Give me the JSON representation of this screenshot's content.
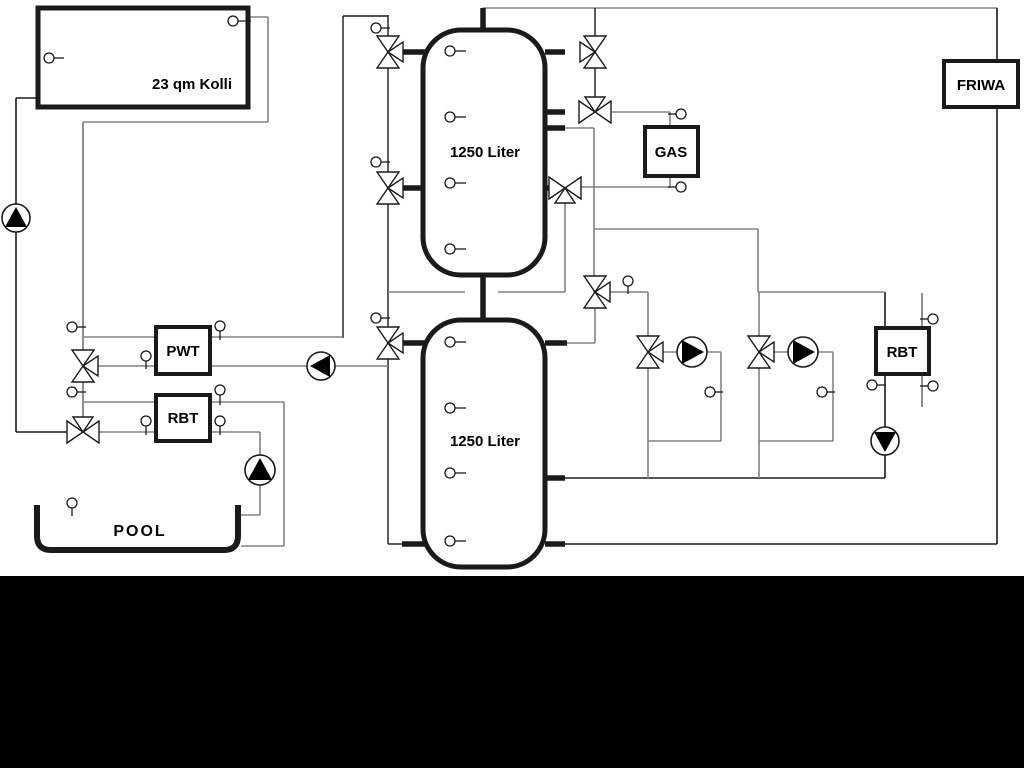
{
  "diagram": {
    "canvas": {
      "width": 1024,
      "height": 768,
      "background": "#ffffff"
    },
    "colors": {
      "black_line": "#1a1a1a",
      "gray_line": "#828282",
      "symbol_stroke": "#1a1a1a",
      "fill_white": "#ffffff",
      "band": "#000000"
    },
    "black_band": {
      "x": 0,
      "y": 576,
      "width": 1024,
      "height": 192
    },
    "boxes": [
      {
        "id": "collector-box",
        "label": "23 qm Kolli",
        "x": 38,
        "y": 8,
        "w": 210,
        "h": 99,
        "border": 5,
        "label_x": 192,
        "label_y": 89,
        "font": 15
      },
      {
        "id": "pwt-box",
        "label": "PWT",
        "x": 156,
        "y": 327,
        "w": 54,
        "h": 47,
        "border": 4,
        "label_x": 183,
        "label_y": 356,
        "font": 15
      },
      {
        "id": "rbt-pool-box",
        "label": "RBT",
        "x": 156,
        "y": 395,
        "w": 54,
        "h": 46,
        "border": 4,
        "label_x": 183,
        "label_y": 423,
        "font": 15
      },
      {
        "id": "gas-box",
        "label": "GAS",
        "x": 645,
        "y": 127,
        "w": 53,
        "h": 49,
        "border": 4,
        "label_x": 671,
        "label_y": 157,
        "font": 15
      },
      {
        "id": "rbt-heating-box",
        "label": "RBT",
        "x": 876,
        "y": 328,
        "w": 53,
        "h": 46,
        "border": 4,
        "label_x": 902,
        "label_y": 357,
        "font": 15
      },
      {
        "id": "friwa-box",
        "label": "FRIWA",
        "x": 944,
        "y": 61,
        "w": 74,
        "h": 46,
        "border": 4,
        "label_x": 981,
        "label_y": 90,
        "font": 15
      }
    ],
    "tanks": [
      {
        "id": "buffer-tank-1",
        "label": "1250 Liter",
        "x": 423,
        "y": 30,
        "w": 122,
        "h": 245,
        "rx": 38,
        "border": 5,
        "label_x": 485,
        "label_y": 157,
        "font": 15
      },
      {
        "id": "buffer-tank-2",
        "label": "1250 Liter",
        "x": 423,
        "y": 320,
        "w": 122,
        "h": 247,
        "rx": 38,
        "border": 5,
        "label_x": 485,
        "label_y": 446,
        "font": 15
      }
    ],
    "pool": {
      "id": "pool-basin",
      "label": "POOL",
      "path": "M 37,505 L 37,536 Q 37,550 51,550 L 224,550 Q 238,550 238,536 L 238,505",
      "border": 6,
      "label_x": 140,
      "label_y": 536,
      "font": 16
    },
    "lines": [
      [
        16,
        98,
        38,
        98,
        "b",
        1.6
      ],
      [
        16,
        98,
        16,
        432,
        "b",
        1.6
      ],
      [
        16,
        432,
        83,
        432,
        "b",
        1.6
      ],
      [
        483,
        8,
        997,
        8,
        "g",
        1.6
      ],
      [
        997,
        8,
        997,
        544,
        "b",
        1.6
      ],
      [
        565,
        544,
        997,
        544,
        "b",
        1.6
      ],
      [
        565,
        478,
        885,
        478,
        "b",
        1.6
      ],
      [
        885,
        292,
        885,
        478,
        "b",
        1.6
      ],
      [
        595,
        8,
        595,
        112,
        "b",
        1.4
      ],
      [
        343,
        16,
        343,
        338,
        "b",
        1.4
      ],
      [
        343,
        16,
        388,
        16,
        "b",
        1.4
      ],
      [
        388,
        15,
        388,
        544,
        "b",
        1.4
      ],
      [
        388,
        544,
        404,
        544,
        "b",
        1.4
      ],
      [
        248,
        17,
        268,
        17,
        "g",
        1.6
      ],
      [
        268,
        17,
        268,
        122,
        "g",
        1.6
      ],
      [
        83,
        122,
        268,
        122,
        "g",
        1.6
      ],
      [
        83,
        122,
        83,
        432,
        "g",
        1.8
      ],
      [
        83,
        337,
        156,
        337,
        "g",
        1.6
      ],
      [
        210,
        337,
        343,
        337,
        "g",
        1.6
      ],
      [
        83,
        366,
        156,
        366,
        "g",
        1.6
      ],
      [
        210,
        366,
        388,
        366,
        "g",
        1.6
      ],
      [
        83,
        402,
        156,
        402,
        "g",
        1.6
      ],
      [
        210,
        402,
        284,
        402,
        "g",
        1.6
      ],
      [
        284,
        402,
        284,
        546,
        "g",
        1.6
      ],
      [
        241,
        546,
        284,
        546,
        "g",
        1.6
      ],
      [
        83,
        432,
        156,
        432,
        "g",
        1.6
      ],
      [
        210,
        432,
        260,
        432,
        "g",
        1.6
      ],
      [
        260,
        432,
        260,
        515,
        "g",
        1.6
      ],
      [
        241,
        515,
        260,
        515,
        "g",
        1.6
      ],
      [
        545,
        128,
        594,
        128,
        "g",
        1.6
      ],
      [
        594,
        128,
        594,
        292,
        "g",
        1.6
      ],
      [
        594,
        229,
        758,
        229,
        "g",
        1.6
      ],
      [
        758,
        229,
        758,
        292,
        "g",
        1.6
      ],
      [
        758,
        292,
        885,
        292,
        "g",
        1.6
      ],
      [
        759,
        292,
        759,
        478,
        "g",
        1.6
      ],
      [
        648,
        292,
        648,
        478,
        "g",
        1.6
      ],
      [
        595,
        292,
        648,
        292,
        "g",
        1.6
      ],
      [
        565,
        188,
        565,
        292,
        "g",
        1.6
      ],
      [
        388,
        292,
        465,
        292,
        "g",
        1.6
      ],
      [
        498,
        292,
        565,
        292,
        "g",
        1.6
      ],
      [
        595,
        292,
        595,
        343,
        "g",
        1.6
      ],
      [
        567,
        343,
        595,
        343,
        "g",
        1.6
      ],
      [
        612,
        112,
        670,
        112,
        "g",
        1.6
      ],
      [
        670,
        112,
        670,
        128,
        "g",
        1.6
      ],
      [
        580,
        187,
        670,
        187,
        "g",
        1.6
      ],
      [
        670,
        174,
        670,
        187,
        "g",
        1.6
      ],
      [
        663,
        352,
        721,
        352,
        "g",
        1.6
      ],
      [
        721,
        352,
        721,
        441,
        "g",
        1.6
      ],
      [
        648,
        441,
        721,
        441,
        "g",
        1.6
      ],
      [
        774,
        352,
        833,
        352,
        "g",
        1.6
      ],
      [
        833,
        352,
        833,
        441,
        "g",
        1.6
      ],
      [
        759,
        441,
        833,
        441,
        "g",
        1.6
      ],
      [
        922,
        293,
        922,
        407,
        "g",
        1.8
      ]
    ],
    "thick_stubs": [
      [
        483,
        8,
        483,
        32
      ],
      [
        402,
        52,
        425,
        52
      ],
      [
        402,
        188,
        425,
        188
      ],
      [
        545,
        52,
        565,
        52
      ],
      [
        545,
        112,
        565,
        112
      ],
      [
        545,
        128,
        565,
        128
      ],
      [
        545,
        188,
        560,
        188
      ],
      [
        483,
        273,
        483,
        322
      ],
      [
        400,
        343,
        425,
        343
      ],
      [
        402,
        544,
        425,
        544
      ],
      [
        545,
        343,
        567,
        343
      ],
      [
        545,
        478,
        565,
        478
      ],
      [
        545,
        544,
        565,
        544
      ]
    ],
    "valves": [
      {
        "id": "valve-tank1-top-left",
        "cx": 388,
        "cy": 52,
        "axis": "v",
        "branch": "right"
      },
      {
        "id": "valve-tank1-bottom-left",
        "cx": 388,
        "cy": 188,
        "axis": "v",
        "branch": "right"
      },
      {
        "id": "valve-tank2-top-left",
        "cx": 388,
        "cy": 343,
        "axis": "v",
        "branch": "right"
      },
      {
        "id": "valve-solar-pwt",
        "cx": 83,
        "cy": 366,
        "axis": "v",
        "branch": "right"
      },
      {
        "id": "valve-solar-pool",
        "cx": 83,
        "cy": 432,
        "axis": "h",
        "branch": "top"
      },
      {
        "id": "valve-tank1-top-right",
        "cx": 595,
        "cy": 52,
        "axis": "v",
        "branch": "left"
      },
      {
        "id": "valve-gas-flow",
        "cx": 595,
        "cy": 112,
        "axis": "h",
        "branch": "top"
      },
      {
        "id": "valve-gas-return",
        "cx": 565,
        "cy": 188,
        "axis": "h",
        "branch": "bottom"
      },
      {
        "id": "valve-mid-distribution",
        "cx": 595,
        "cy": 292,
        "axis": "v",
        "branch": "right"
      },
      {
        "id": "valve-circuit-1",
        "cx": 648,
        "cy": 352,
        "axis": "v",
        "branch": "right"
      },
      {
        "id": "valve-circuit-2",
        "cx": 759,
        "cy": 352,
        "axis": "v",
        "branch": "right"
      }
    ],
    "pumps": [
      {
        "id": "pump-solar",
        "cx": 16,
        "cy": 218,
        "r": 14,
        "dir": "up"
      },
      {
        "id": "pump-pwt",
        "cx": 321,
        "cy": 366,
        "r": 14,
        "dir": "left"
      },
      {
        "id": "pump-pool",
        "cx": 260,
        "cy": 470,
        "r": 15,
        "dir": "up"
      },
      {
        "id": "pump-circuit-1",
        "cx": 692,
        "cy": 352,
        "r": 15,
        "dir": "right"
      },
      {
        "id": "pump-circuit-2",
        "cx": 803,
        "cy": 352,
        "r": 15,
        "dir": "right"
      },
      {
        "id": "pump-rbt-return",
        "cx": 885,
        "cy": 441,
        "r": 14,
        "dir": "down"
      }
    ],
    "sensors": [
      {
        "cx": 233,
        "cy": 21,
        "stem": "right",
        "len": 13
      },
      {
        "cx": 49,
        "cy": 58,
        "stem": "right",
        "len": 10
      },
      {
        "cx": 72,
        "cy": 327,
        "stem": "right",
        "len": 9
      },
      {
        "cx": 72,
        "cy": 392,
        "stem": "right",
        "len": 9
      },
      {
        "cx": 146,
        "cy": 356,
        "stem": "down",
        "len": 8
      },
      {
        "cx": 220,
        "cy": 326,
        "stem": "down",
        "len": 9
      },
      {
        "cx": 146,
        "cy": 421,
        "stem": "down",
        "len": 9
      },
      {
        "cx": 220,
        "cy": 390,
        "stem": "down",
        "len": 10
      },
      {
        "cx": 220,
        "cy": 421,
        "stem": "down",
        "len": 9
      },
      {
        "cx": 72,
        "cy": 503,
        "stem": "down",
        "len": 8
      },
      {
        "cx": 376,
        "cy": 28,
        "stem": "right",
        "len": 9
      },
      {
        "cx": 376,
        "cy": 162,
        "stem": "right",
        "len": 9
      },
      {
        "cx": 376,
        "cy": 318,
        "stem": "right",
        "len": 9
      },
      {
        "cx": 450,
        "cy": 51,
        "stem": "right",
        "len": 11
      },
      {
        "cx": 450,
        "cy": 117,
        "stem": "right",
        "len": 11
      },
      {
        "cx": 450,
        "cy": 183,
        "stem": "right",
        "len": 11
      },
      {
        "cx": 450,
        "cy": 249,
        "stem": "right",
        "len": 11
      },
      {
        "cx": 450,
        "cy": 342,
        "stem": "right",
        "len": 11
      },
      {
        "cx": 450,
        "cy": 408,
        "stem": "right",
        "len": 11
      },
      {
        "cx": 450,
        "cy": 473,
        "stem": "right",
        "len": 11
      },
      {
        "cx": 450,
        "cy": 541,
        "stem": "right",
        "len": 11
      },
      {
        "cx": 628,
        "cy": 281,
        "stem": "down",
        "len": 8
      },
      {
        "cx": 681,
        "cy": 114,
        "stem": "left",
        "len": 8
      },
      {
        "cx": 681,
        "cy": 187,
        "stem": "left",
        "len": 8
      },
      {
        "cx": 710,
        "cy": 392,
        "stem": "right",
        "len": 8
      },
      {
        "cx": 822,
        "cy": 392,
        "stem": "right",
        "len": 8
      },
      {
        "cx": 872,
        "cy": 385,
        "stem": "right",
        "len": 9
      },
      {
        "cx": 933,
        "cy": 319,
        "stem": "left",
        "len": 8
      },
      {
        "cx": 933,
        "cy": 386,
        "stem": "left",
        "len": 8
      }
    ]
  }
}
